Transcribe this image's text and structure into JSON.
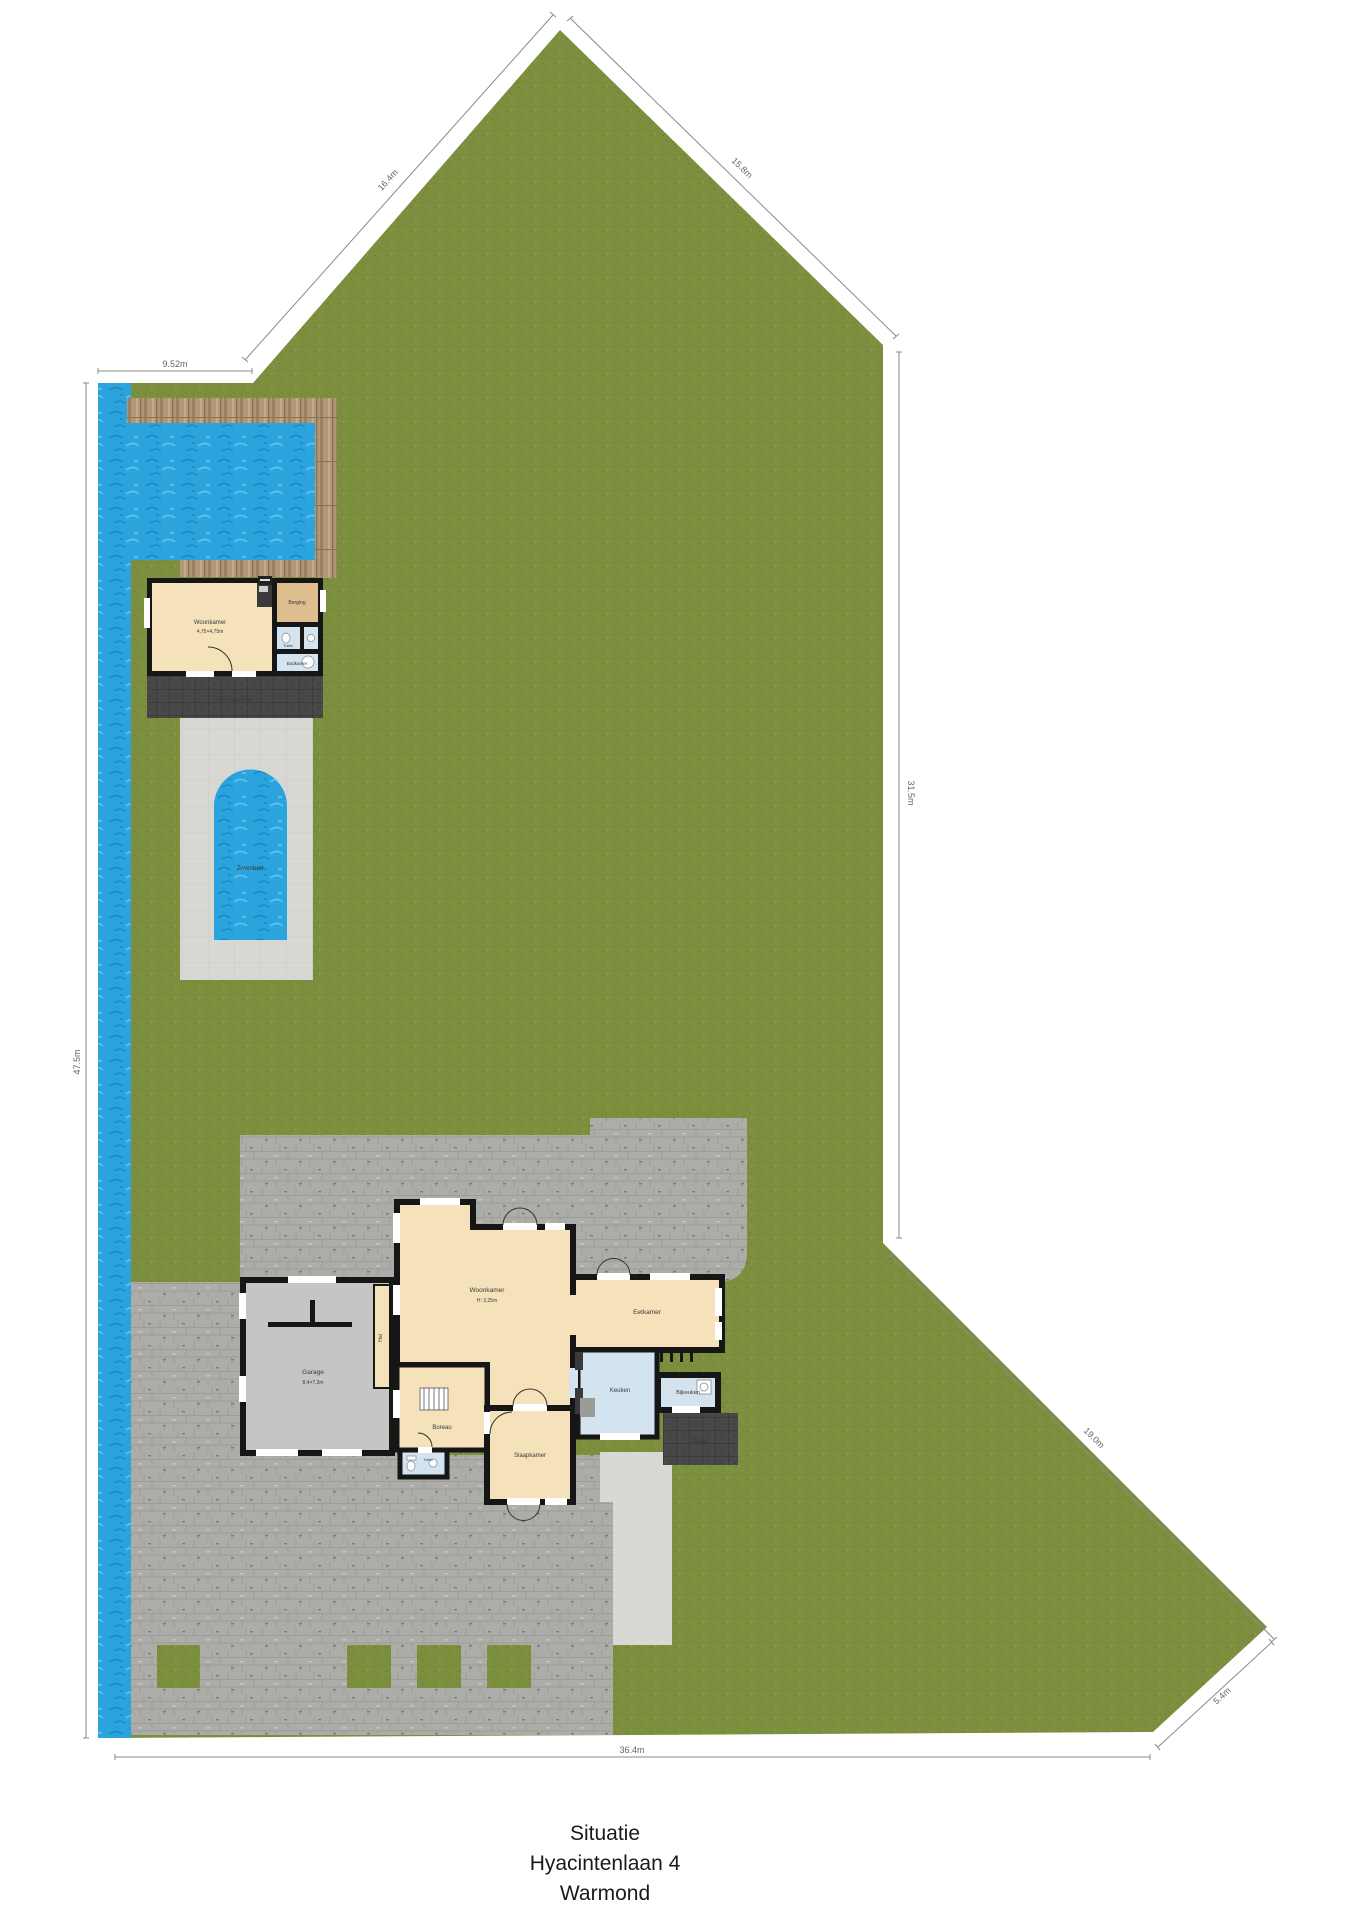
{
  "caption": {
    "title": "Situatie",
    "address": "Hyacintenlaan 4",
    "city": "Warmond"
  },
  "main_house": {
    "woonkamer": {
      "name": "Woonkamer",
      "sub": "H: 3,25m"
    },
    "eetkamer": {
      "name": "Eetkamer"
    },
    "keuken": {
      "name": "Keuken"
    },
    "bijkeuken": {
      "name": "Bijkeuken"
    },
    "bureau": {
      "name": "Bureau"
    },
    "slaapkamer": {
      "name": "Slaapkamer"
    },
    "toilet": {
      "name": "Toilet"
    },
    "garage": {
      "name": "Garage",
      "sub": "8,4×7,3m"
    },
    "hal": {
      "name": "Hal"
    },
    "terras": {
      "name": "Terras"
    }
  },
  "outbuilding": {
    "woonkamer": {
      "name": "Woonkamer",
      "sub": "4,75×4,75m"
    },
    "berging": {
      "name": "Berging"
    },
    "toilet": {
      "name": "Toilet"
    },
    "badkamer": {
      "name": "Badkamer"
    },
    "overkapping": {
      "name": "Overkapping"
    }
  },
  "site": {
    "zwembad": "Zwembad"
  },
  "dimensions": {
    "top_left": "9.52m",
    "left_diagonal": "16.4m",
    "right_diagonal": "15.8m",
    "right_vertical": "31.5m",
    "bottom_right_upper": "19.0m",
    "bottom_right_lower": "5.4m",
    "bottom": "36.4m",
    "left_vertical": "47.5m"
  },
  "colors": {
    "grass": "#7C8F3E",
    "water": "#2BA4DE",
    "deck_wood": "#B29877",
    "paving_brick": "#ABABA7",
    "paving_smooth": "#D8D8D5",
    "pool_terrace": "#D7D7D4",
    "floor_beige": "#F5E1BA",
    "floor_blue": "#D4E3F0",
    "floor_garage": "#C5C5C3",
    "floor_tan": "#DEBE8E",
    "wall": "#161616",
    "terrace_dark": "#484848"
  }
}
